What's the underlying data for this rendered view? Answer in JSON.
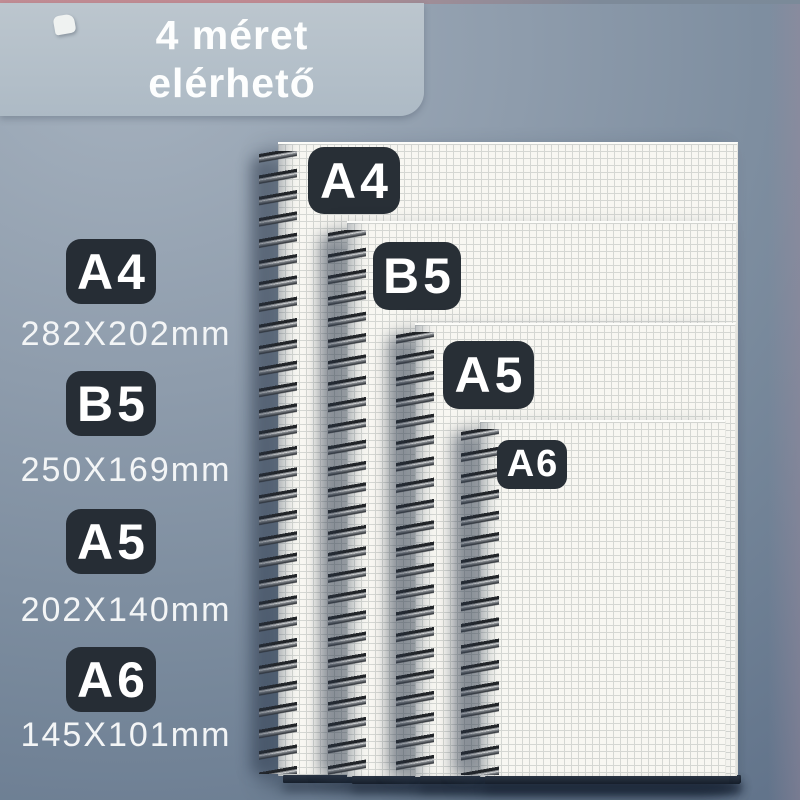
{
  "banner": {
    "line1": "4 méret",
    "line2": "elérhető"
  },
  "legend": {
    "items": [
      {
        "code": "A4",
        "dims": "282X202mm"
      },
      {
        "code": "B5",
        "dims": "250X169mm"
      },
      {
        "code": "A5",
        "dims": "202X140mm"
      },
      {
        "code": "A6",
        "dims": "145X101mm"
      }
    ]
  },
  "notebooks": {
    "labels": [
      "A4",
      "B5",
      "A5",
      "A6"
    ]
  },
  "colors": {
    "top_strip_pink": "#c38d95",
    "banner_bg": "#b6c1ca",
    "banner_text": "#fdfefe",
    "badge_bg": "#282f36",
    "badge_text": "#ffffff",
    "dims_text": "#f3f5f6",
    "paper": "#f8f7f2",
    "paper_grid": "#d5d7d3",
    "background_slate_top": "#a6b2bf",
    "background_slate_bottom": "#5d6f87"
  }
}
